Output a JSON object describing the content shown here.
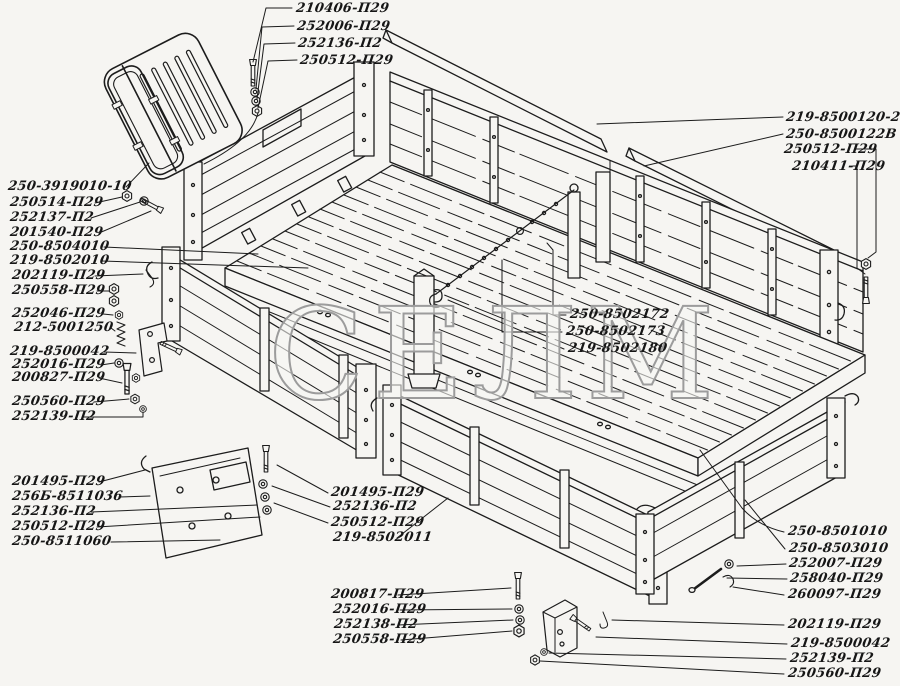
{
  "watermark": {
    "text": "СЕЛМ"
  },
  "colors": {
    "paper": "#f6f5f2",
    "ink": "#1c1c1c",
    "watermark": "#9c9c9c"
  },
  "part_labels": [
    {
      "text": "210406-П29"
    },
    {
      "text": "252006-П29"
    },
    {
      "text": "252136-П2"
    },
    {
      "text": "250512-П29"
    },
    {
      "text": "219-8500120-20"
    },
    {
      "text": "250-8500122В"
    },
    {
      "text": "250512-П29"
    },
    {
      "text": "210411-П29"
    },
    {
      "text": "250-3919010-10"
    },
    {
      "text": "250514-П29"
    },
    {
      "text": "252137-П2"
    },
    {
      "text": "201540-П29"
    },
    {
      "text": "250-8504010"
    },
    {
      "text": "219-8502010"
    },
    {
      "text": "202119-П29"
    },
    {
      "text": "250558-П29"
    },
    {
      "text": "252046-П29"
    },
    {
      "text": "212-5001250"
    },
    {
      "text": "219-8500042"
    },
    {
      "text": "252016-П29"
    },
    {
      "text": "200827-П29"
    },
    {
      "text": "250560-П29"
    },
    {
      "text": "252139-П2"
    },
    {
      "text": "201495-П29"
    },
    {
      "text": "256Б-8511036"
    },
    {
      "text": "252136-П2"
    },
    {
      "text": "250512-П29"
    },
    {
      "text": "250-8511060"
    },
    {
      "text": "250-8502172"
    },
    {
      "text": "250-8502173"
    },
    {
      "text": "219-8502180"
    },
    {
      "text": "201495-П29"
    },
    {
      "text": "252136-П2"
    },
    {
      "text": "250512-П29"
    },
    {
      "text": "219-8502011"
    },
    {
      "text": "200817-П29"
    },
    {
      "text": "252016-П29"
    },
    {
      "text": "252138-П2"
    },
    {
      "text": "250558-П29"
    },
    {
      "text": "250-8501010"
    },
    {
      "text": "250-8503010"
    },
    {
      "text": "252007-П29"
    },
    {
      "text": "258040-П29"
    },
    {
      "text": "260097-П29"
    },
    {
      "text": "202119-П29"
    },
    {
      "text": "219-8500042"
    },
    {
      "text": "252139-П2"
    },
    {
      "text": "250560-П29"
    }
  ]
}
